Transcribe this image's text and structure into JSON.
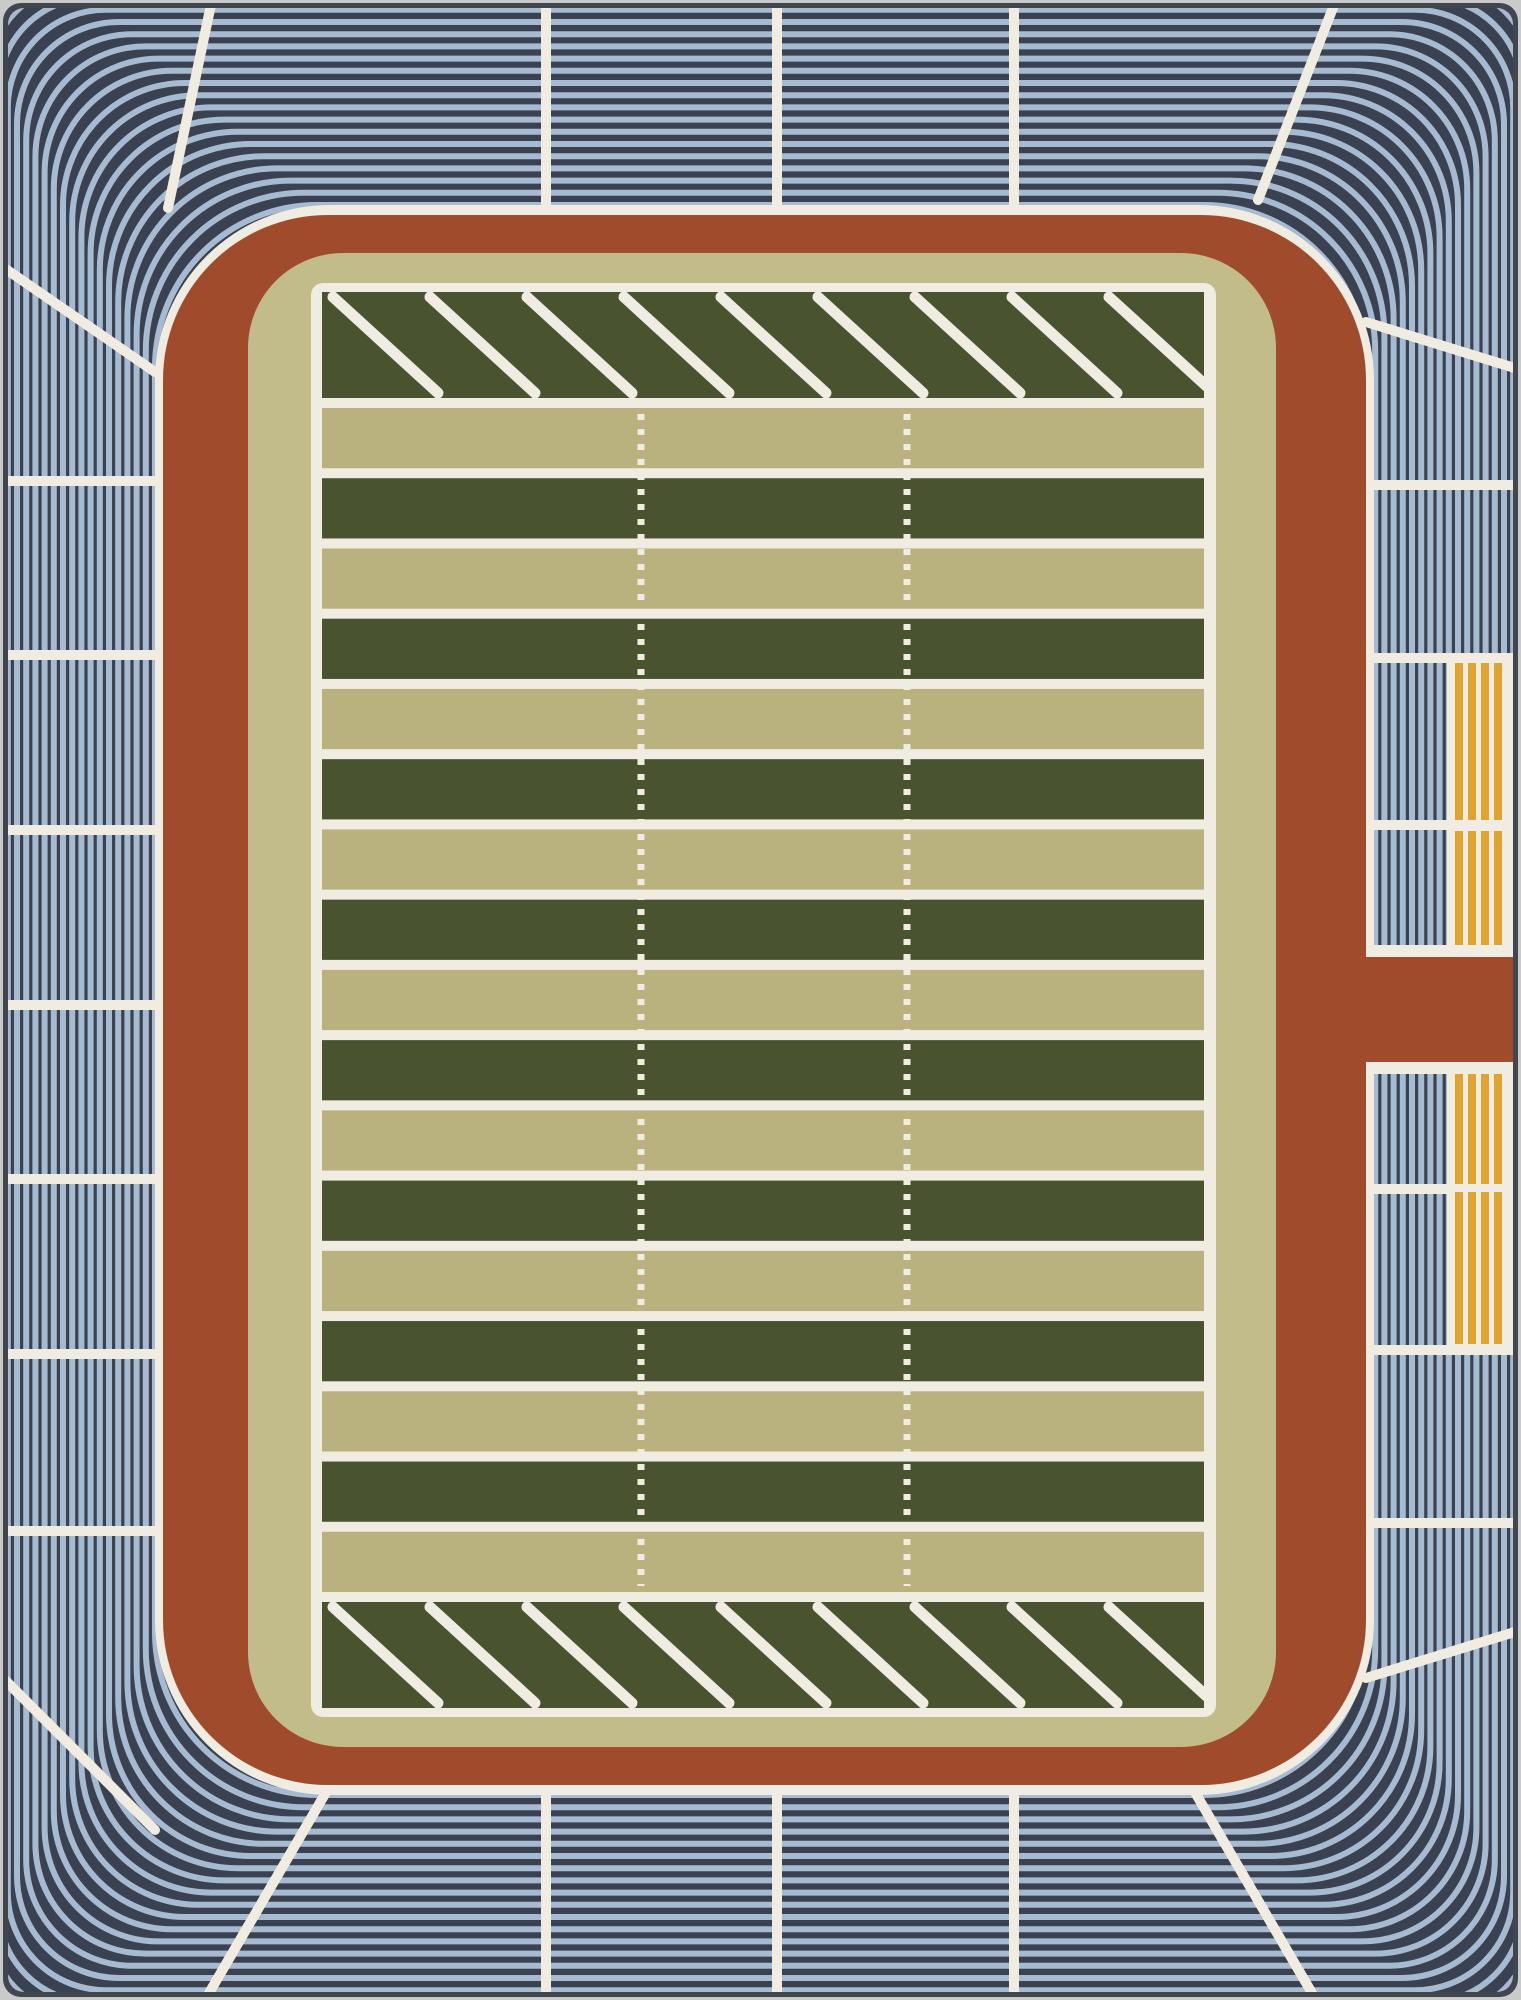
{
  "meta": {
    "alt": "Overhead-view stadium play rug: blue striped bleachers, rust running track with right-side tunnel, gold seating blocks, and a green and tan striped football field with hash marks and slashed end zones"
  },
  "palette": {
    "photo_edge": "#c9cbca",
    "rug_edge": "#42474e",
    "bleacher_dark": "#3a4150",
    "bleacher_light": "#a6bbd2",
    "line_white": "#f1ece1",
    "track_rust": "#a04c2c",
    "apron_tan": "#c2bb8a",
    "field_tan": "#b9b27e",
    "field_green": "#4a5330",
    "vip_gold": "#e0a32f"
  },
  "rug": {
    "width": 1521,
    "height": 2000,
    "edge_inset": 3,
    "margin": 8,
    "corner_radius": 16
  },
  "bleachers": {
    "ring_count": 25,
    "ring_stroke": 6,
    "inset_top": 205,
    "inset_side": 155,
    "step_top": 12.2,
    "step_side": 9.2,
    "inner_radius": 162,
    "radius_step": 4,
    "min_radius": 30
  },
  "dividers": {
    "line_width": 10,
    "top_x": [
      546,
      777,
      1014
    ],
    "bottom_x": [
      546,
      777,
      1014
    ],
    "left_y": [
      481,
      655,
      830,
      1005,
      1179,
      1354,
      1531
    ],
    "right_y": [
      485,
      658,
      825,
      1189,
      1350,
      1523
    ],
    "corner_lines": [
      [
        212,
        0,
        168,
        208
      ],
      [
        0,
        265,
        155,
        372
      ],
      [
        1336,
        0,
        1258,
        200
      ],
      [
        1366,
        322,
        1521,
        370
      ],
      [
        0,
        1675,
        155,
        1830
      ],
      [
        205,
        2000,
        332,
        1782
      ],
      [
        1366,
        1678,
        1521,
        1630
      ],
      [
        1316,
        2000,
        1189,
        1782
      ]
    ]
  },
  "concourse": {
    "rect": [
      155,
      205,
      1374,
      1795
    ],
    "radius": 175
  },
  "track": {
    "rect": [
      163,
      215,
      1366,
      1785
    ],
    "radius": 165
  },
  "tunnel": {
    "x0": 1366,
    "x1": 1521,
    "white_y0": 945,
    "white_y1": 1074,
    "rust_y0": 957,
    "rust_y1": 1062
  },
  "apron": {
    "rect": [
      248,
      253,
      1276,
      1747
    ],
    "radius": 95
  },
  "field_border": {
    "rect": [
      311,
      283,
      1216,
      1717
    ],
    "radius": 12
  },
  "field": {
    "rect": [
      322,
      292,
      1204,
      1708
    ],
    "endzone_height": 106,
    "line_width": 10,
    "stripe_count": 17,
    "endzone_diagonals": {
      "count": 9,
      "x0": 333,
      "spacing": 97,
      "run": 105,
      "width": 11
    },
    "hash_columns": {
      "x": [
        641,
        907
      ],
      "width": 7,
      "dash": "6 9"
    }
  },
  "vip": {
    "bg_x": 1447,
    "bg_ranges": [
      [
        655,
        955
      ],
      [
        1062,
        1352
      ]
    ],
    "blocks": [
      [
        663,
        820
      ],
      [
        831,
        947
      ],
      [
        1068,
        1184
      ],
      [
        1192,
        1344
      ]
    ],
    "stripe_x0": 1455,
    "stripe_width": 8,
    "stripe_pitch": 13,
    "stripes_per_block": 4
  }
}
